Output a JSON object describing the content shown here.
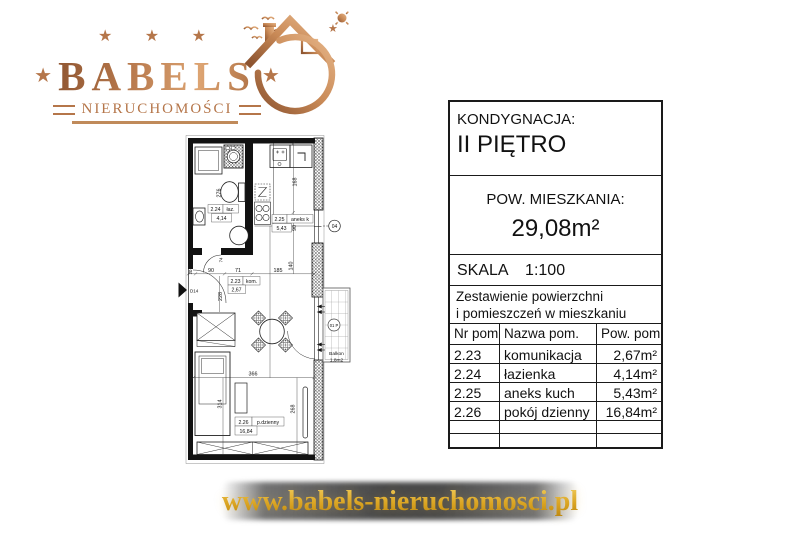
{
  "logo": {
    "brand": "BABELS",
    "subtitle": "NIERUCHOMOŚCI",
    "stars_top": "★ ★ ★",
    "star": "★"
  },
  "info_panel": {
    "kondygnacja_label": "KONDYGNACJA:",
    "kondygnacja_value": "II PIĘTRO",
    "pow_label": "POW. MIESZKANIA:",
    "pow_value": "29,08m²",
    "skala_label": "SKALA",
    "skala_value": "1:100",
    "zestawienie_line1": "Zestawienie powierzchni",
    "zestawienie_line2": "i pomieszczeń w mieszkaniu",
    "table": {
      "headers": [
        "Nr pom.",
        "Nazwa pom.",
        "Pow. pom."
      ],
      "rows": [
        {
          "nr": "2.23",
          "nazwa": "komunikacja",
          "pow": "2,67m²"
        },
        {
          "nr": "2.24",
          "nazwa": "łazienka",
          "pow": "4,14m²"
        },
        {
          "nr": "2.25",
          "nazwa": "aneks kuch",
          "pow": "5,43m²"
        },
        {
          "nr": "2.26",
          "nazwa": "pokój dzienny",
          "pow": "16,84m²"
        }
      ]
    }
  },
  "floorplan": {
    "bathroom": {
      "nr": "2.24",
      "name": "łaz.",
      "area": "4,14"
    },
    "kitchen": {
      "nr": "2.25",
      "name": "aneks k",
      "area": "5,43"
    },
    "hall": {
      "nr": "2.23",
      "name": "kom.",
      "area": "2,67"
    },
    "living": {
      "nr": "2.26",
      "name": "p.dzienny",
      "area": "16,84"
    },
    "balcony": {
      "name": "Balkon",
      "area": "1,8m2",
      "badge": "01 P"
    },
    "window_badge": "04",
    "entrance_label": "D14",
    "dims": {
      "d276": "276",
      "d168": "168",
      "d90w": "90",
      "d20": "20",
      "d74": "74",
      "d90": "90",
      "d71": "71",
      "d185": "185",
      "d140": "140",
      "d228": "228",
      "d366": "366",
      "d314": "314",
      "d268": "268"
    }
  },
  "footer": {
    "url": "www.babels-nieruchomosci.pl"
  },
  "colors": {
    "copper": "#b5764a",
    "gold": "#d9a21f",
    "ink": "#1a1a1a"
  }
}
